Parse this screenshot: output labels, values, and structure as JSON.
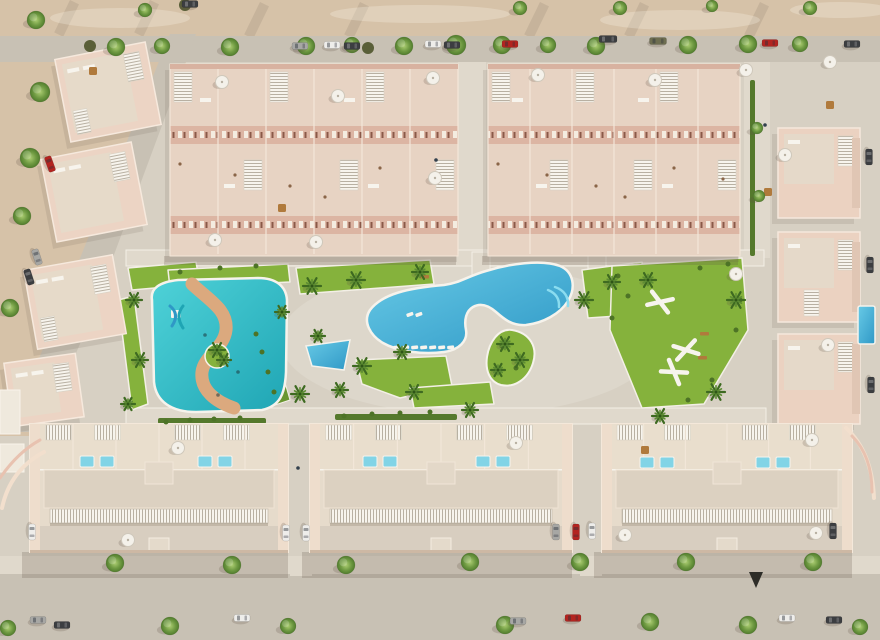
{
  "meta": {
    "title": "aerial-render-residential-complex",
    "width": 880,
    "height": 640
  },
  "palette": {
    "sand": "#dbcbb6",
    "sandTop": "#d6c2a8",
    "sandLight": "#e9ddc8",
    "pavement": "#d7d0c3",
    "pavementLight": "#e0d9cc",
    "road": "#c8c1b4",
    "roadLight": "#d2cbbe",
    "wall": "#e9d3c2",
    "wallFront": "#d8b2a0",
    "wallLight": "#f4e7d9",
    "wallPink": "#e8c2b0",
    "roof": "#e0d5c5",
    "roofLight": "#ece1d2",
    "white": "#f7f4ed",
    "stripe": "#b8b0a2",
    "lawn": "#85b23c",
    "lawnDark": "#6a9630",
    "hedge": "#55792c",
    "shrub": "#4d7326",
    "pool1": "#68cae6",
    "pool2": "#2f98c6",
    "kids1": "#4fd2d8",
    "kids2": "#1fa5b4",
    "river": "#dba97e",
    "steps": "#8adcf0",
    "roofPool": "#82d4e6",
    "treeHi": "#accd72",
    "tree": "#6f9a42",
    "treeDark": "#517c2d",
    "palm": "#3e6a21",
    "palmHi": "#5d8c33",
    "olive": "#5a5f38",
    "shadow": "rgba(95,82,68,0.22)",
    "shadowSoft": "rgba(105,92,76,0.14)",
    "carWhite": "#eeedea",
    "carGray": "#a7a7a4",
    "carDark": "#3c3e41",
    "carRed": "#b32420",
    "carOlive": "#6e6e50",
    "tan": "#b07a3c"
  },
  "scene": {
    "top_sand_h": 36,
    "pavement_rect": [
      0,
      62,
      880,
      498
    ],
    "sand_left_poly": "0,62 186,62 80,330 36,436 0,436",
    "roads": {
      "top": [
        0,
        36,
        880,
        26
      ],
      "left_poly": "170,34 196,34 86,330 42,432 8,432 56,318",
      "bottom_sidewalk": [
        0,
        556,
        880,
        18
      ],
      "bottom_street": [
        0,
        574,
        880,
        66
      ],
      "alleys": [
        [
          458,
          62,
          28,
          196
        ],
        [
          744,
          62,
          26,
          196
        ]
      ],
      "crossings": [
        [
          290,
          556,
          22,
          20
        ],
        [
          580,
          556,
          22,
          20
        ]
      ]
    },
    "streaks": [
      [
        70,
        0,
        36
      ],
      [
        150,
        0,
        36
      ],
      [
        260,
        2,
        36
      ],
      [
        360,
        2,
        36
      ],
      [
        540,
        2,
        36
      ],
      [
        640,
        2,
        36
      ],
      [
        760,
        2,
        36
      ],
      [
        90,
        118,
        60
      ],
      [
        68,
        190,
        60
      ],
      [
        40,
        268,
        60
      ]
    ],
    "light_patches": [
      [
        120,
        18,
        70,
        10
      ],
      [
        420,
        14,
        90,
        9
      ],
      [
        680,
        20,
        80,
        10
      ],
      [
        840,
        10,
        50,
        8
      ],
      [
        470,
        600,
        120,
        14
      ],
      [
        200,
        595,
        90,
        12
      ]
    ],
    "walkways": [
      [
        126,
        250,
        638,
        16
      ],
      [
        126,
        408,
        640,
        16
      ],
      [
        472,
        252,
        18,
        24
      ],
      [
        588,
        252,
        18,
        32
      ]
    ],
    "lawns": [
      "296,268 430,260 434,284 300,294",
      "582,270 642,262 648,314 588,318",
      "356,360 446,356 452,386 400,398 362,384",
      "410,388 490,382 494,404 414,408",
      "612,266 742,258 748,330 704,404 642,408 610,330",
      "128,268 196,262 200,284 132,290",
      "118,300 134,296 148,404 132,410",
      "168,270 288,264 290,282 170,288"
    ],
    "hedge_band": "252,330 268,324 290,400 272,406",
    "hedges": [
      [
        452,
        70,
        5,
        186
      ],
      [
        750,
        80,
        5,
        176
      ],
      [
        158,
        418,
        108,
        6
      ],
      [
        335,
        414,
        122,
        6
      ]
    ],
    "top_blocks": [
      {
        "x": 170,
        "y": 64,
        "w": 288,
        "units": 6,
        "unitW": 48
      },
      {
        "x": 488,
        "y": 64,
        "w": 252,
        "units": 6,
        "unitW": 42
      }
    ],
    "left_villas": [
      {
        "x": 62,
        "y": 50,
        "w": 92,
        "h": 84,
        "a": -11
      },
      {
        "x": 48,
        "y": 150,
        "w": 92,
        "h": 84,
        "a": -11
      },
      {
        "x": 30,
        "y": 262,
        "w": 90,
        "h": 80,
        "a": -10
      },
      {
        "x": 8,
        "y": 358,
        "w": 72,
        "h": 64,
        "a": -8
      }
    ],
    "right_villas": [
      {
        "x": 778,
        "y": 128
      },
      {
        "x": 778,
        "y": 232
      },
      {
        "x": 778,
        "y": 334
      }
    ],
    "left_edge_buildings": [
      [
        0,
        390,
        20,
        44
      ],
      [
        0,
        444,
        24,
        28
      ]
    ],
    "bottom_buildings": [
      {
        "x": 30,
        "w": 258
      },
      {
        "x": 310,
        "w": 262
      },
      {
        "x": 602,
        "w": 250
      }
    ],
    "roof_pools": [
      [
        80,
        456
      ],
      [
        100,
        456
      ],
      [
        198,
        456
      ],
      [
        218,
        456
      ],
      [
        363,
        456
      ],
      [
        383,
        456
      ],
      [
        476,
        456
      ],
      [
        496,
        456
      ],
      [
        640,
        457
      ],
      [
        660,
        457
      ],
      [
        756,
        457
      ],
      [
        776,
        457
      ]
    ],
    "pools": {
      "kids_path": "M152,300 C150,288 160,282 178,280 L258,278 C276,278 286,286 287,300 L286,372 C285,394 280,406 262,410 L196,412 C172,412 156,402 154,382 Z",
      "river_path": "M192,284 C210,301 228,310 226,330 C224,348 204,356 202,372 C200,390 216,402 234,408",
      "kids_island": {
        "cx": 217,
        "cy": 356,
        "r": 12
      },
      "slide": {
        "x": 176,
        "y": 314
      },
      "floats": [
        [
          205,
          335
        ],
        [
          238,
          372
        ],
        [
          218,
          395
        ]
      ],
      "main_path": "M370,310 C382,294 408,288 444,285 C460,283 468,276 486,271 C508,264 542,259 560,266 C574,272 576,288 568,301 C560,314 543,323 526,325 C512,326 504,319 496,312 C488,305 480,303 473,307 C466,311 464,320 466,330 C468,341 459,350 444,352 C421,355 397,351 383,343 C371,336 362,322 370,310 Z",
      "steps": [
        "M548,290 q12,5 11,17",
        "M555,287 q14,5 13,19"
      ],
      "main_island_path": "M512,330 C530,333 538,347 533,363 C528,379 515,388 501,385 C490,382 485,371 487,357 C489,343 498,328 512,330 Z",
      "tri_poly": "306,346 350,340 344,370 312,366",
      "right_edge": [
        858,
        306,
        17,
        38
      ]
    },
    "lounger_rows": [
      {
        "x": 393,
        "y": 346,
        "n": 7,
        "dx": 9,
        "a": -6
      },
      {
        "x": 406,
        "y": 314,
        "n": 2,
        "dx": 9,
        "a": -20
      }
    ],
    "calisthenics": [
      [
        660,
        302,
        20
      ],
      [
        686,
        350,
        -15
      ],
      [
        674,
        372,
        35
      ]
    ],
    "benches": [
      [
        420,
        275
      ],
      [
        700,
        332
      ],
      [
        698,
        356
      ]
    ],
    "patio_sets": [
      [
        93,
        71
      ],
      [
        282,
        208
      ],
      [
        768,
        192
      ],
      [
        645,
        450
      ],
      [
        830,
        105
      ]
    ],
    "shrubs": [
      [
        256,
        334
      ],
      [
        262,
        352
      ],
      [
        268,
        372
      ],
      [
        274,
        392
      ],
      [
        618,
        276
      ],
      [
        628,
        296
      ],
      [
        612,
        318
      ],
      [
        700,
        268
      ],
      [
        728,
        264
      ],
      [
        740,
        300
      ],
      [
        736,
        330
      ],
      [
        712,
        380
      ],
      [
        688,
        400
      ],
      [
        180,
        272
      ],
      [
        220,
        268
      ],
      [
        256,
        266
      ],
      [
        166,
        422
      ],
      [
        190,
        420
      ],
      [
        214,
        419
      ],
      [
        240,
        418
      ],
      [
        344,
        416
      ],
      [
        372,
        414
      ],
      [
        400,
        413
      ],
      [
        430,
        412
      ],
      [
        502,
        346
      ],
      [
        516,
        368
      ]
    ],
    "trees": [
      [
        116,
        47,
        9
      ],
      [
        162,
        46,
        8
      ],
      [
        230,
        47,
        9
      ],
      [
        306,
        46,
        9
      ],
      [
        352,
        45,
        8
      ],
      [
        404,
        46,
        9
      ],
      [
        456,
        45,
        10
      ],
      [
        502,
        45,
        9
      ],
      [
        548,
        45,
        8
      ],
      [
        596,
        46,
        9
      ],
      [
        688,
        45,
        9
      ],
      [
        748,
        44,
        9
      ],
      [
        800,
        44,
        8
      ],
      [
        145,
        10,
        7
      ],
      [
        520,
        8,
        7
      ],
      [
        620,
        8,
        7
      ],
      [
        712,
        6,
        6
      ],
      [
        810,
        8,
        7
      ],
      [
        36,
        20,
        9
      ],
      [
        40,
        92,
        10
      ],
      [
        30,
        158,
        10
      ],
      [
        22,
        216,
        9
      ],
      [
        10,
        308,
        9
      ],
      [
        757,
        128,
        6
      ],
      [
        759,
        196,
        6
      ],
      [
        115,
        563,
        9
      ],
      [
        232,
        565,
        9
      ],
      [
        346,
        565,
        9
      ],
      [
        470,
        562,
        9
      ],
      [
        580,
        562,
        9
      ],
      [
        686,
        562,
        9
      ],
      [
        813,
        562,
        9
      ],
      [
        8,
        628,
        8
      ],
      [
        170,
        626,
        9
      ],
      [
        288,
        626,
        8
      ],
      [
        505,
        625,
        9
      ],
      [
        650,
        622,
        9
      ],
      [
        748,
        625,
        9
      ],
      [
        860,
        627,
        8
      ]
    ],
    "palms": [
      [
        312,
        286,
        9
      ],
      [
        356,
        280,
        9
      ],
      [
        420,
        272,
        8
      ],
      [
        584,
        300,
        9
      ],
      [
        612,
        282,
        8
      ],
      [
        648,
        280,
        8
      ],
      [
        736,
        300,
        9
      ],
      [
        716,
        392,
        9
      ],
      [
        660,
        416,
        8
      ],
      [
        362,
        366,
        9
      ],
      [
        402,
        352,
        8
      ],
      [
        300,
        394,
        9
      ],
      [
        340,
        390,
        8
      ],
      [
        414,
        392,
        8
      ],
      [
        470,
        410,
        8
      ],
      [
        134,
        300,
        8
      ],
      [
        140,
        360,
        8
      ],
      [
        128,
        404,
        7
      ],
      [
        217,
        350,
        8
      ],
      [
        224,
        360,
        7
      ],
      [
        282,
        312,
        7
      ],
      [
        318,
        336,
        7
      ],
      [
        505,
        344,
        8
      ],
      [
        520,
        360,
        8
      ],
      [
        498,
        370,
        7
      ]
    ],
    "olive_bushes": [
      [
        90,
        46
      ],
      [
        368,
        48
      ],
      [
        185,
        5
      ]
    ],
    "cars": [
      [
        300,
        46,
        0,
        "gray"
      ],
      [
        332,
        45,
        0,
        "white"
      ],
      [
        352,
        46,
        0,
        "dark"
      ],
      [
        433,
        44,
        0,
        "white"
      ],
      [
        452,
        45,
        0,
        "dark"
      ],
      [
        510,
        44,
        0,
        "red"
      ],
      [
        608,
        39,
        0,
        "dark",
        18
      ],
      [
        658,
        41,
        0,
        "olive",
        17
      ],
      [
        770,
        43,
        0,
        "red"
      ],
      [
        852,
        44,
        0,
        "dark"
      ],
      [
        190,
        4,
        0,
        "dark"
      ],
      [
        50,
        164,
        70,
        "red"
      ],
      [
        37,
        257,
        72,
        "gray"
      ],
      [
        29,
        277,
        72,
        "dark"
      ],
      [
        869,
        157,
        90,
        "dark"
      ],
      [
        870,
        265,
        90,
        "dark"
      ],
      [
        871,
        385,
        90,
        "dark"
      ],
      [
        32,
        532,
        90,
        "white"
      ],
      [
        286,
        533,
        90,
        "white"
      ],
      [
        306,
        533,
        90,
        "white"
      ],
      [
        556,
        532,
        90,
        "gray"
      ],
      [
        576,
        532,
        90,
        "red"
      ],
      [
        592,
        531,
        90,
        "white"
      ],
      [
        833,
        531,
        90,
        "dark"
      ],
      [
        38,
        620,
        0,
        "gray"
      ],
      [
        62,
        625,
        0,
        "dark"
      ],
      [
        242,
        618,
        0,
        "white"
      ],
      [
        518,
        621,
        0,
        "gray"
      ],
      [
        573,
        618,
        0,
        "red"
      ],
      [
        787,
        618,
        0,
        "white"
      ],
      [
        834,
        620,
        0,
        "dark"
      ]
    ],
    "umbrellas": [
      [
        222,
        82
      ],
      [
        338,
        96
      ],
      [
        433,
        78
      ],
      [
        538,
        75
      ],
      [
        655,
        80
      ],
      [
        746,
        70
      ],
      [
        830,
        62
      ],
      [
        785,
        155
      ],
      [
        215,
        240
      ],
      [
        316,
        242
      ],
      [
        435,
        178
      ],
      [
        736,
        274
      ],
      [
        828,
        345
      ],
      [
        178,
        448
      ],
      [
        516,
        443
      ],
      [
        812,
        440
      ],
      [
        128,
        540
      ],
      [
        625,
        535
      ],
      [
        816,
        533
      ]
    ],
    "persons": [
      [
        765,
        125
      ],
      [
        436,
        160
      ],
      [
        298,
        468
      ]
    ],
    "street_marker": "749,572 763,572 756,588",
    "walls": [
      "M2,508 Q10,470 44,452",
      "M0,478 Q18,452 40,440",
      "M846,428 Q872,452 874,498",
      "M852,436 Q872,456 872,492"
    ],
    "block_shadows": [
      [
        164,
        256,
        292,
        9
      ],
      [
        482,
        256,
        256,
        9
      ]
    ],
    "bottom_shadows": [
      [
        22,
        552,
        266,
        26
      ],
      [
        302,
        552,
        270,
        26
      ],
      [
        594,
        552,
        258,
        26
      ]
    ]
  }
}
